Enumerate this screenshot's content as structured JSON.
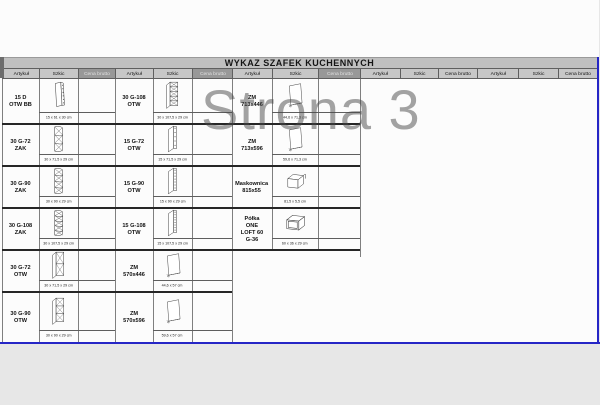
{
  "sheet": {
    "title": "WYKAZ SZAFEK KUCHENNYCH",
    "watermark_page_label": "Strona 3",
    "columns": [
      "Artykuł",
      "Szkic",
      "Cena brutto"
    ]
  },
  "colors": {
    "page_border_blue": "#2626c6",
    "title_bar_bg": "#c0c0c0",
    "header_bg": "#c7c7c7",
    "header_highlight_bg": "#989898",
    "watermark_gray": "#8f8f8f"
  },
  "groups": [
    {
      "cena_header_highlighted": true,
      "rows": [
        {
          "name": "15 D OTW BB",
          "dims": "15 x 61 x 30 cm",
          "sketch": "side-panel-with-holes"
        },
        {
          "name": "30 G-72 ZAK",
          "dims": "30 x 71,5 x 29 cm",
          "sketch": "corner-open-shelf-3"
        },
        {
          "name": "30 G-90 ZAK",
          "dims": "30 x 90 x 29 cm",
          "sketch": "corner-open-shelf-4"
        },
        {
          "name": "30 G-108 ZAK",
          "dims": "30 x 107,5 x 29 cm",
          "sketch": "corner-open-shelf-5"
        },
        {
          "name": "30 G-72 OTW",
          "dims": "30 x 71,5 x 29 cm",
          "sketch": "open-shelf-cabinet-2"
        },
        {
          "name": "30 G-90 OTW",
          "dims": "30 x 90 x 29 cm",
          "sketch": "open-shelf-cabinet-3"
        }
      ]
    },
    {
      "cena_header_highlighted": true,
      "rows": [
        {
          "name": "30 G-108 OTW",
          "dims": "30 x 107,5 x 29 cm",
          "sketch": "open-shelf-cabinet-5"
        },
        {
          "name": "15 G-72 OTW",
          "dims": "15 x 71,5 x 29 cm",
          "sketch": "narrow-open-shelf-5"
        },
        {
          "name": "15 G-90 OTW",
          "dims": "15 x 90 x 29 cm",
          "sketch": "narrow-open-shelf-7"
        },
        {
          "name": "15 G-108 OTW",
          "dims": "15 x 107,5 x 29 cm",
          "sketch": "narrow-open-shelf-8"
        },
        {
          "name": "ZM 570x446",
          "dims": "44,6 x 57 cm",
          "sketch": "door-panel"
        },
        {
          "name": "ZM 570x596",
          "dims": "59,6 x 57 cm",
          "sketch": "door-panel"
        }
      ]
    },
    {
      "cena_header_highlighted": true,
      "rows": [
        {
          "name": "ZM 713x446",
          "dims": "44,6 x 71,3 cm",
          "sketch": "door-panel"
        },
        {
          "name": "ZM 713x596",
          "dims": "59,6 x 71,3 cm",
          "sketch": "door-panel"
        },
        {
          "name": "Maskownica 815x55",
          "dims": "81,5 x 5,5 cm",
          "sketch": "cover-strip-3d"
        },
        {
          "name": "Półka ONE LOFT 60 G-36",
          "dims": "60 x 36 x 29 cm",
          "sketch": "open-box-shelf"
        }
      ]
    },
    {
      "cena_header_highlighted": false,
      "rows": []
    },
    {
      "cena_header_highlighted": false,
      "rows": []
    }
  ]
}
